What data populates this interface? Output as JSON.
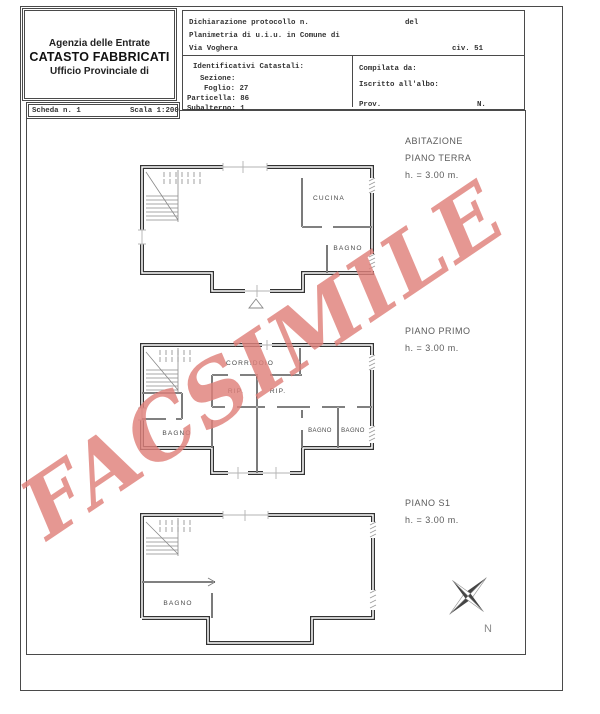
{
  "header_box": {
    "line1": "Agenzia delle Entrate",
    "line2": "CATASTO FABBRICATI",
    "line3": "Ufficio Provinciale di"
  },
  "protocol_form": {
    "row1_label": "Dichiarazione protocollo n.",
    "row1_del": "del",
    "row2": "Planimetria di u.i.u. in Comune di",
    "row3_street": "Via Voghera",
    "row3_civ": "civ. 51",
    "cadastral": {
      "title": "Identificativi Catastali:",
      "sezione": "Sezione:",
      "foglio": "Foglio: 27",
      "particella": "Particella: 86",
      "subalterno": "Subalterno: 1"
    },
    "compiled": {
      "compilata": "Compilata da:",
      "iscritto": "Iscritto all'albo:",
      "prov": "Prov.",
      "n": "N."
    }
  },
  "scheda_box": {
    "scheda": "Scheda n. 1",
    "scala": "Scala 1:200"
  },
  "watermark": {
    "text": "FACSIMILE",
    "color": "#e0817b"
  },
  "floors": [
    {
      "building": "ABITAZIONE",
      "floor_label": "PIANO TERRA",
      "height_label": "h. = 3.00 m.",
      "rooms": [
        "CUCINA",
        "BAGNO"
      ]
    },
    {
      "floor_label": "PIANO PRIMO",
      "height_label": "h. = 3.00 m.",
      "rooms": [
        "CORRIDOIO",
        "RIP.",
        "RIP.",
        "BAGNO",
        "BAGNO",
        "BAGNO"
      ]
    },
    {
      "floor_label": "PIANO S1",
      "height_label": "h. = 3.00 m.",
      "rooms": [
        "BAGNO"
      ]
    }
  ],
  "compass": {
    "label": "N"
  }
}
